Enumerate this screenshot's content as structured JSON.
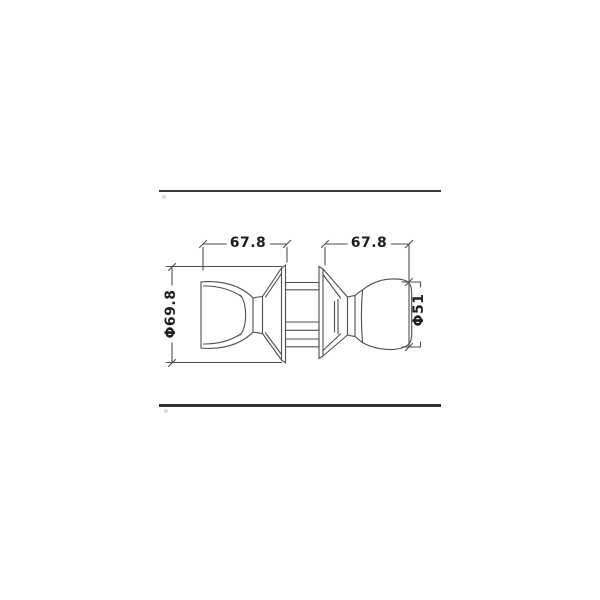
{
  "drawing": {
    "labels": {
      "left_width": "67.8",
      "right_width": "67.8",
      "left_diameter": "Φ69.8",
      "right_diameter": "Φ51"
    },
    "colors": {
      "background": "#ffffff",
      "line": "#4e4e4e",
      "text": "#1d1d1d",
      "border_rule": "#3a3a3a"
    }
  }
}
